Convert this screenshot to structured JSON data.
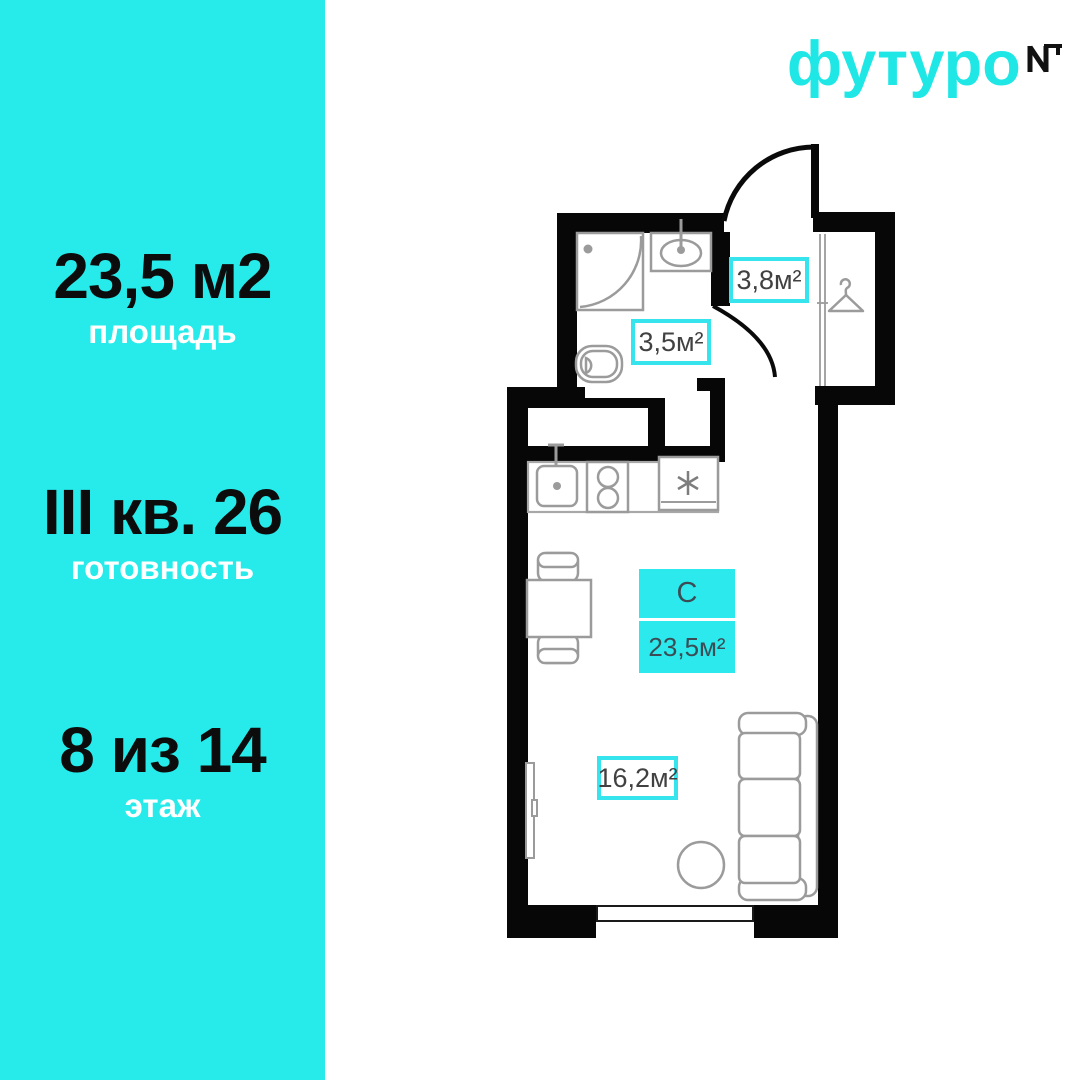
{
  "brand": {
    "logo_text": "футуро",
    "logo_mark": "NT",
    "logo_color": "#1fe7e6"
  },
  "sidebar": {
    "bg": "#26ebea",
    "stats": [
      {
        "value": "23,5 м2",
        "label": "площадь"
      },
      {
        "value": "III кв. 26",
        "label": "готовность"
      },
      {
        "value": "8 из 14",
        "label": "этаж"
      }
    ]
  },
  "floorplan": {
    "accent": "#35e4ec",
    "wall_color": "#070707",
    "fixture_color": "#9b9b9b",
    "unit_type": "С",
    "total_area": "23,5м²",
    "rooms": [
      {
        "name": "bathroom",
        "area": "3,5м²"
      },
      {
        "name": "hallway",
        "area": "3,8м²"
      },
      {
        "name": "living-room",
        "area": "16,2м²"
      }
    ]
  }
}
